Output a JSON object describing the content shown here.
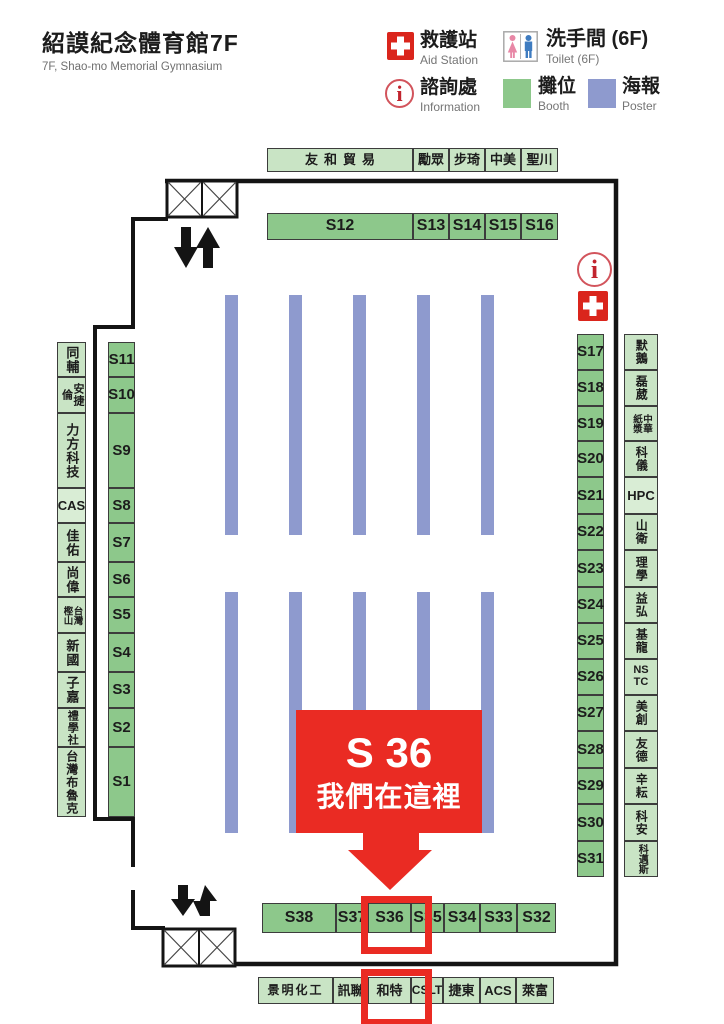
{
  "header": {
    "title": "紹謨紀念體育館7F",
    "subtitle": "7F, Shao-mo Memorial Gymnasium"
  },
  "legend": {
    "aid_station": {
      "zh": "救護站",
      "en": "Aid Station",
      "color": "#da251c"
    },
    "toilet": {
      "zh": "洗手間 (6F)",
      "en": "Toilet (6F)"
    },
    "information": {
      "zh": "諮詢處",
      "en": "Information",
      "icon_glyph": "i",
      "color": "#c1242e"
    },
    "booth": {
      "zh": "攤位",
      "en": "Booth",
      "color": "#8dc88b"
    },
    "poster": {
      "zh": "海報",
      "en": "Poster",
      "color": "#8e9ace"
    }
  },
  "map": {
    "top_company_row": [
      "友和貿易",
      "勵眾",
      "步琦",
      "中美",
      "聖川"
    ],
    "top_booth_row": [
      "S12",
      "S13",
      "S14",
      "S15",
      "S16"
    ],
    "left_company_col": [
      "同輔",
      "安捷倫",
      "力方科技",
      "CAS",
      "佳佑",
      "尚偉",
      "台灣\n樫山",
      "新國",
      "子嘉",
      "禮學社",
      "台灣布魯克"
    ],
    "left_booth_col": [
      "S11",
      "S10",
      "S9",
      "S8",
      "S7",
      "S6",
      "S5",
      "S4",
      "S3",
      "S2",
      "S1"
    ],
    "right_booth_col": [
      "S17",
      "S18",
      "S19",
      "S20",
      "S21",
      "S22",
      "S23",
      "S24",
      "S25",
      "S26",
      "S27",
      "S28",
      "S29",
      "S30",
      "S31"
    ],
    "right_company_col": [
      "默鵝",
      "磊葳",
      "中華\n紙漿",
      "科儀",
      "HPC",
      "山衛",
      "理學",
      "益弘",
      "基龍",
      "NS\nTC",
      "美創",
      "友德",
      "辛耘",
      "科安",
      "科邁斯"
    ],
    "bottom_booth_row": [
      "S38",
      "S37",
      "S36",
      "S35",
      "S34",
      "S33",
      "S32"
    ],
    "bottom_company_row": [
      "景明化工",
      "訊聯",
      "和特",
      "CSLT",
      "捷東",
      "ACS",
      "萊富"
    ],
    "callout": {
      "line1": "S 36",
      "line2": "我們在這裡"
    },
    "highlighted_booth": "S36",
    "highlighted_company": "和特",
    "info_icon_glyph": "i"
  }
}
